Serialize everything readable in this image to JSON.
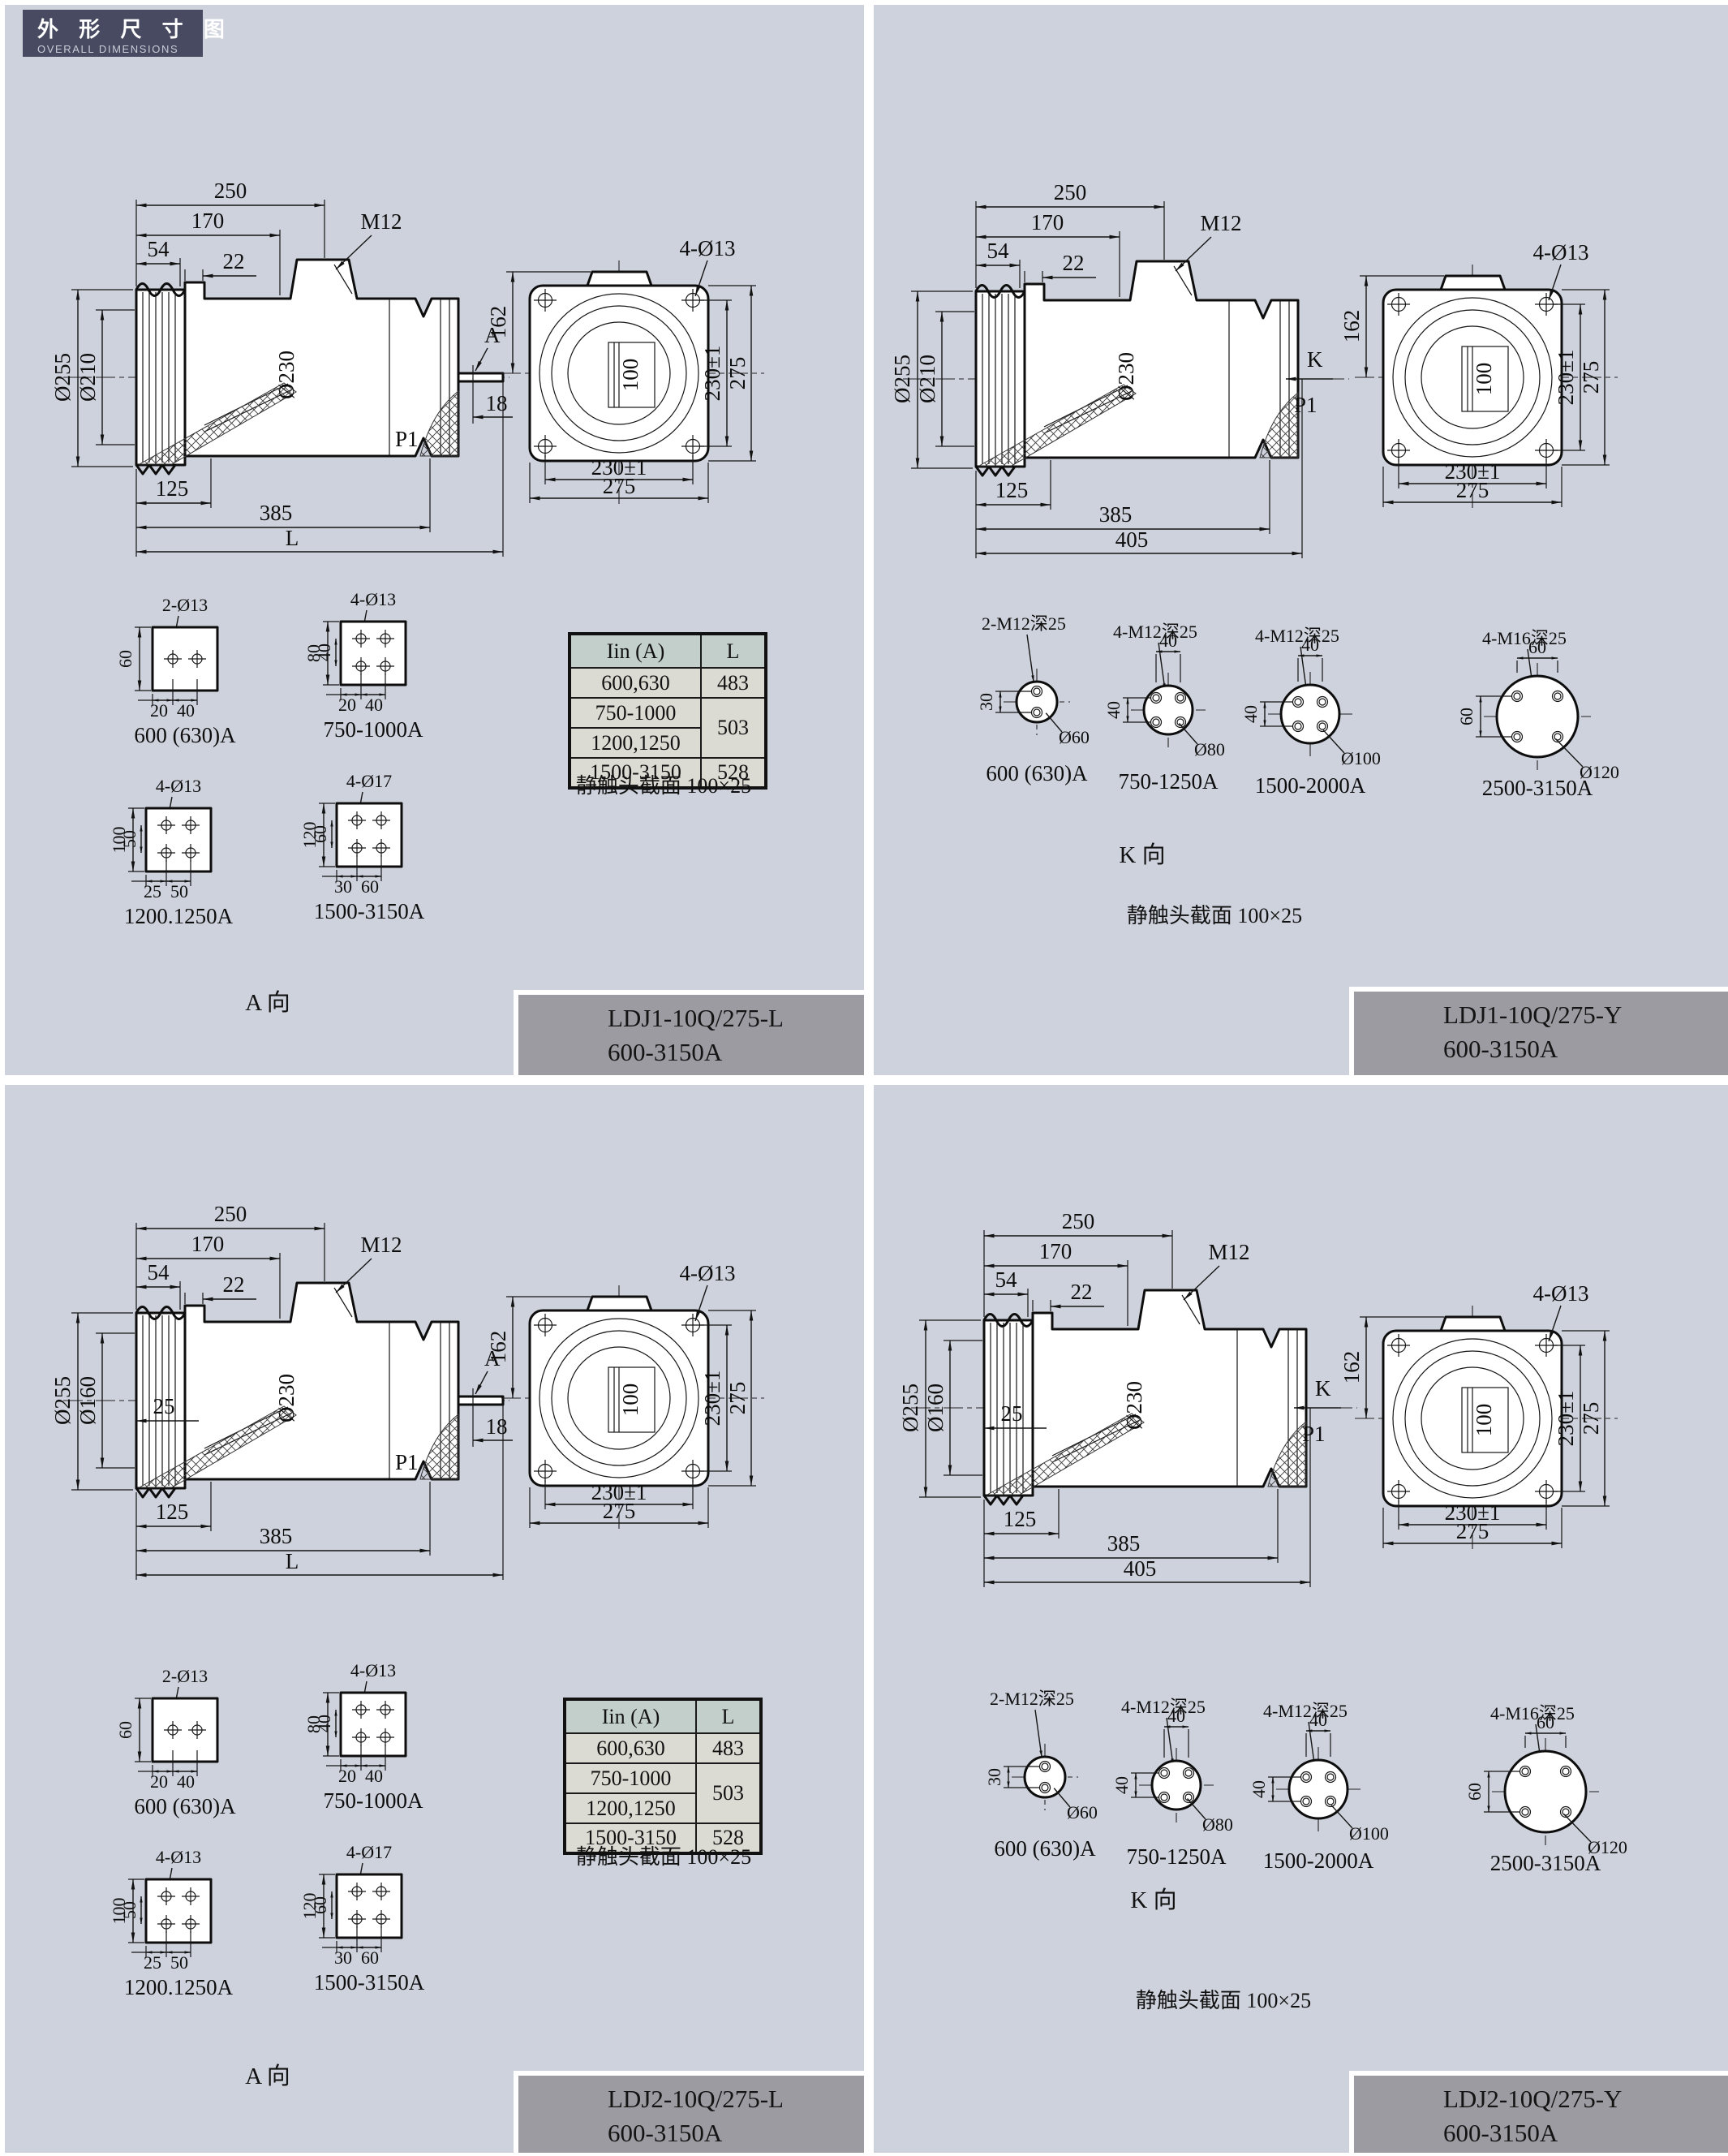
{
  "header": {
    "title_cn": "外 形 尺 寸 图",
    "title_en": "OVERALL DIMENSIONS"
  },
  "colors": {
    "page_bg": "#ced2dc",
    "header_bg": "#474a60",
    "label_box_bg": "#9b9ba1",
    "table_header_bg": "#c3cfca",
    "table_cell_bg": "#dcdbd3"
  },
  "captions": {
    "a_view": "A 向",
    "k_view": "K 向",
    "section_note": "静触头截面 100×25"
  },
  "table": {
    "h1": "Iin (A)",
    "h2": "L",
    "r1c1": "600,630",
    "r1c2": "483",
    "r2c1": "750-1000",
    "r2c2": "503",
    "r3c1": "1200,1250",
    "r4c1": "1500-3150",
    "r4c2": "528"
  },
  "front_view": {
    "holes": "4-Ø13",
    "height": "162",
    "bar": "100",
    "inner_w": "230±1",
    "outer_w": "275",
    "inner_h": "230±1",
    "outer_h": "275"
  },
  "bolt_patterns": [
    {
      "title": "2-Ø13",
      "outer": "60",
      "inner": "",
      "bot1": "20",
      "bot2": "40",
      "label": "600 (630)A"
    },
    {
      "title": "4-Ø13",
      "outer": "80",
      "inner": "40",
      "bot1": "20",
      "bot2": "40",
      "label": "750-1000A"
    },
    {
      "title": "4-Ø13",
      "outer": "100",
      "inner": "50",
      "bot1": "25",
      "bot2": "50",
      "label": "1200.1250A"
    },
    {
      "title": "4-Ø17",
      "outer": "120",
      "inner": "60",
      "bot1": "30",
      "bot2": "60",
      "label": "1500-3150A"
    }
  ],
  "circle_patterns": [
    {
      "title": "2-M12深25",
      "top": "",
      "left": "30",
      "dia": "Ø60",
      "label": "600 (630)A"
    },
    {
      "title": "4-M12深25",
      "top": "40",
      "left": "40",
      "dia": "Ø80",
      "label": "750-1250A"
    },
    {
      "title": "4-M12深25",
      "top": "40",
      "left": "40",
      "dia": "Ø100",
      "label": "1500-2000A"
    },
    {
      "title": "4-M16深25",
      "top": "60",
      "left": "60",
      "dia": "Ø120",
      "label": "2500-3150A"
    }
  ],
  "quadrants": {
    "tl": {
      "model": "LDJ1-10Q/275-L",
      "range": "600-3150A",
      "side": {
        "d1": "250",
        "d2": "170",
        "d3": "54",
        "d4": "22",
        "m12": "M12",
        "dia_outer": "Ø255",
        "dia_inner": "Ø210",
        "dia_body": "Ø230",
        "b1": "125",
        "b2": "385",
        "b3": "L",
        "p1": "P1",
        "a": "A",
        "d18": "18"
      }
    },
    "tr": {
      "model": "LDJ1-10Q/275-Y",
      "range": "600-3150A",
      "side": {
        "d1": "250",
        "d2": "170",
        "d3": "54",
        "d4": "22",
        "m12": "M12",
        "dia_outer": "Ø255",
        "dia_inner": "Ø210",
        "dia_body": "Ø230",
        "b1": "125",
        "b2": "385",
        "b3": "405",
        "p1": "P1",
        "k": "K"
      }
    },
    "bl": {
      "model": "LDJ2-10Q/275-L",
      "range": "600-3150A",
      "side": {
        "d1": "250",
        "d2": "170",
        "d3": "54",
        "d4": "22",
        "m12": "M12",
        "dia_outer": "Ø255",
        "dia_inner": "Ø160",
        "dia_body": "Ø230",
        "d25": "25",
        "b1": "125",
        "b2": "385",
        "b3": "L",
        "p1": "P1",
        "a": "A",
        "d18": "18"
      }
    },
    "br": {
      "model": "LDJ2-10Q/275-Y",
      "range": "600-3150A",
      "side": {
        "d1": "250",
        "d2": "170",
        "d3": "54",
        "d4": "22",
        "m12": "M12",
        "dia_outer": "Ø255",
        "dia_inner": "Ø160",
        "dia_body": "Ø230",
        "d25": "25",
        "b1": "125",
        "b2": "385",
        "b3": "405",
        "p1": "P1",
        "k": "K"
      }
    }
  }
}
